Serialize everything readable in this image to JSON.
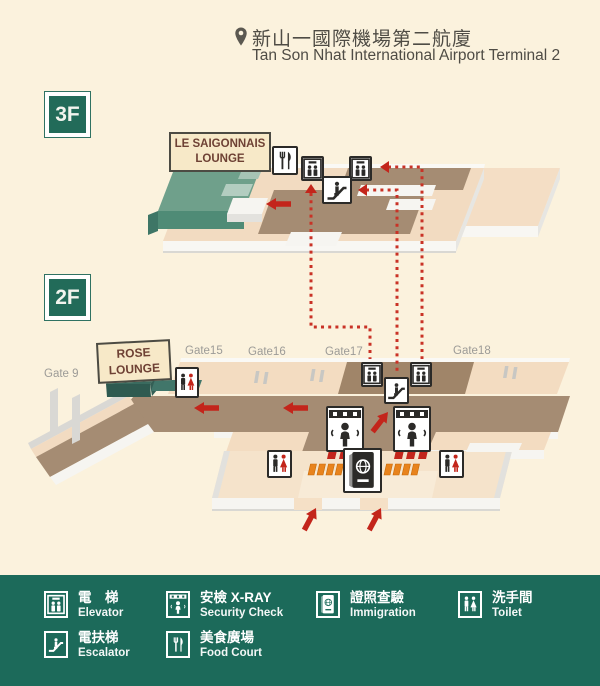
{
  "header": {
    "title_zh": "新山一國際機場第二航廈",
    "title_en": "Tan Son Nhat International Airport Terminal 2"
  },
  "floors": {
    "f3": {
      "label": "3F",
      "lounge_line1": "LE SAIGONNAIS",
      "lounge_line2": "LOUNGE"
    },
    "f2": {
      "label": "2F",
      "lounge_line1": "ROSE",
      "lounge_line2": "LOUNGE",
      "gates": [
        "Gate 9",
        "Gate15",
        "Gate16",
        "Gate17",
        "Gate18"
      ]
    }
  },
  "legend": {
    "items": [
      {
        "id": "elevator",
        "zh": "電　梯",
        "en": "Elevator"
      },
      {
        "id": "security",
        "zh": "安檢 X-RAY",
        "en": "Security Check"
      },
      {
        "id": "immigration",
        "zh": "證照查驗",
        "en": "Immigration"
      },
      {
        "id": "toilet",
        "zh": "洗手間",
        "en": "Toilet"
      },
      {
        "id": "escalator",
        "zh": "電扶梯",
        "en": "Escalator"
      },
      {
        "id": "foodcourt",
        "zh": "美食廣場",
        "en": "Food Court"
      }
    ]
  },
  "colors": {
    "background": "#FBF2DD",
    "legend_green": "#1C6A5A",
    "badge_green": "#226B59",
    "route_red": "#C3251B",
    "seat_orange": "#E8831D",
    "corridor_brown": "#A58C73",
    "floor_peach": "#F3DCC1",
    "lounge_green": "#6FA08B",
    "label_cream": "#F7E9C8",
    "gate_gray": "#9C9B97"
  }
}
